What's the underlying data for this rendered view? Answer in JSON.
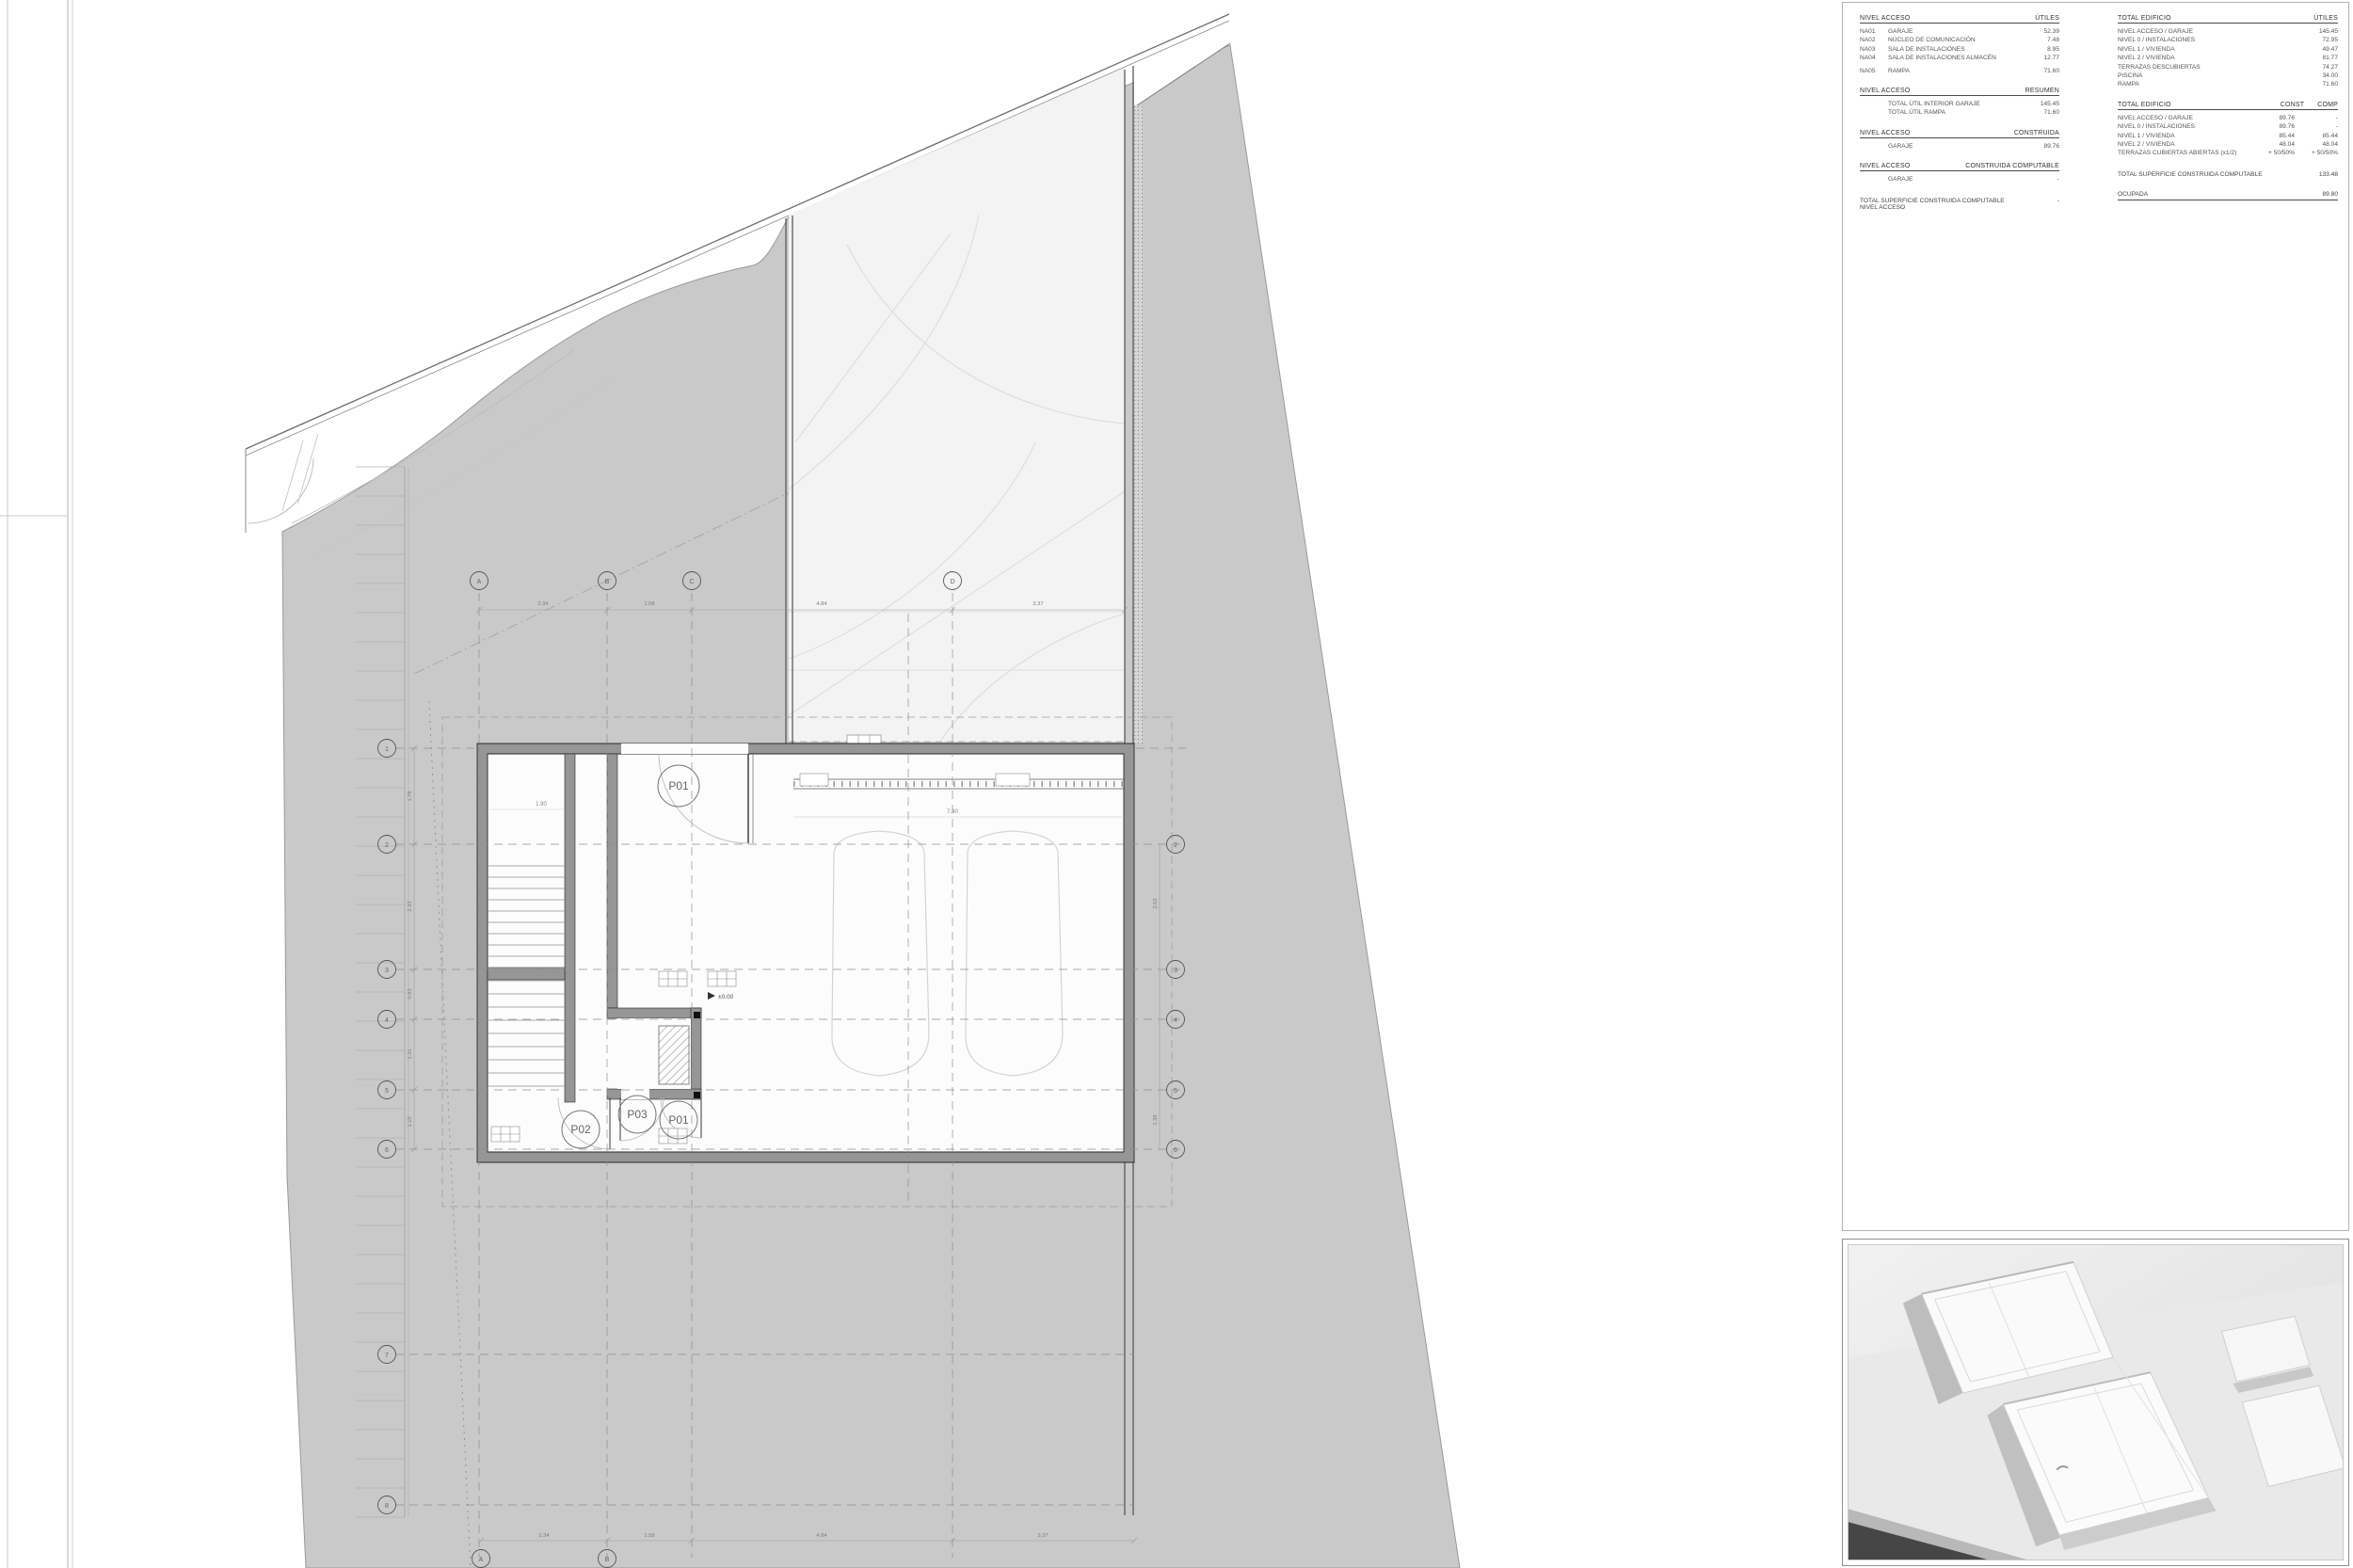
{
  "colors": {
    "site_gray": "#c9c9c9",
    "courtyard": "#f3f3f3",
    "wall_fill": "#969696",
    "model_shadow": "#4a4a4a"
  },
  "plan": {
    "doors": {
      "top": "P01",
      "bottom_left": "P02",
      "bottom_mid": "P03",
      "bottom_right": "P01"
    },
    "level_marker": "±0.00",
    "room_dim": "1.90",
    "garage_dim": "7.90",
    "grid_top": [
      "A",
      "B",
      "C",
      "D"
    ],
    "grid_bottom": [
      "A",
      "B"
    ],
    "grid_left": [
      "1",
      "2",
      "3",
      "4",
      "5",
      "6",
      "7",
      "8"
    ],
    "grid_right": [
      "2",
      "3",
      "4",
      "5",
      "6"
    ],
    "dims_top": [
      "2.34",
      "1.58",
      "4.84",
      "3.37"
    ],
    "dims_bottom": [
      "2.34",
      "1.58",
      "4.84",
      "3.37"
    ],
    "dims_left": [
      "1.78",
      "2.33",
      "0.93",
      "1.31",
      "1.10"
    ],
    "dims_right": [
      "2.53",
      "1.38"
    ]
  },
  "tables": {
    "left": [
      {
        "title": "NIVEL ACCESO",
        "cols": [
          "ÚTILES"
        ],
        "rows": [
          [
            "NA01",
            "GARAJE",
            "52.39"
          ],
          [
            "NA02",
            "NÚCLEO DE COMUNICACIÓN",
            "7.48"
          ],
          [
            "NA03",
            "SALA DE INSTALACIONES",
            "8.95"
          ],
          [
            "NA04",
            "SALA DE INSTALACIONES ALMACÉN",
            "12.77"
          ],
          [
            "NA05",
            "RAMPA",
            "71.60"
          ]
        ]
      },
      {
        "title": "NIVEL ACCESO",
        "cols": [
          "RESUMEN"
        ],
        "rows": [
          [
            "",
            "TOTAL ÚTIL INTERIOR GARAJE",
            "145.45"
          ],
          [
            "",
            "TOTAL ÚTIL RAMPA",
            "71.60"
          ]
        ]
      },
      {
        "title": "NIVEL ACCESO",
        "cols": [
          "CONSTRUIDA"
        ],
        "rows": [
          [
            "",
            "GARAJE",
            "89.76"
          ]
        ]
      },
      {
        "title": "NIVEL ACCESO",
        "cols": [
          "CONSTRUIDA COMPUTABLE"
        ],
        "rows": [
          [
            "",
            "GARAJE",
            "-"
          ]
        ]
      }
    ],
    "left_total": {
      "label": "TOTAL SUPERFICIE CONSTRUIDA COMPUTABLE NIVEL ACCESO",
      "value": "-"
    },
    "right_utiles": {
      "title": "TOTAL EDIFICIO",
      "cols": [
        "ÚTILES"
      ],
      "rows": [
        [
          "NIVEL ACCESO / GARAJE",
          "145.45"
        ],
        [
          "NIVEL 0 / INSTALACIONES",
          "72.95"
        ],
        [
          "NIVEL 1 / VIVIENDA",
          "49.47"
        ],
        [
          "NIVEL 2 / VIVIENDA",
          "81.77"
        ],
        [
          "TERRAZAS DESCUBIERTAS",
          "74.27"
        ],
        [
          "PISCINA",
          "34.00"
        ],
        [
          "RAMPA",
          "71.60"
        ]
      ]
    },
    "right_const": {
      "title": "TOTAL EDIFICIO",
      "cols": [
        "CONST",
        "COMP"
      ],
      "rows": [
        [
          "NIVEL ACCESO / GARAJE",
          "89.76",
          "-"
        ],
        [
          "NIVEL 0 / INSTALACIONES",
          "89.76",
          "-"
        ],
        [
          "NIVEL 1 / VIVIENDA",
          "85.44",
          "85.44"
        ],
        [
          "NIVEL 2 / VIVIENDA",
          "48.04",
          "48.04"
        ],
        [
          "TERRAZAS CUBIERTAS ABIERTAS (x1/2)",
          "+ 50/50%",
          "+ 50/50%"
        ]
      ]
    },
    "right_totals": [
      {
        "label": "TOTAL SUPERFICIE CONSTRUIDA COMPUTABLE",
        "value": "133.48",
        "underline": false
      },
      {
        "label": "OCUPADA",
        "value": "89.80",
        "underline": true
      }
    ]
  }
}
